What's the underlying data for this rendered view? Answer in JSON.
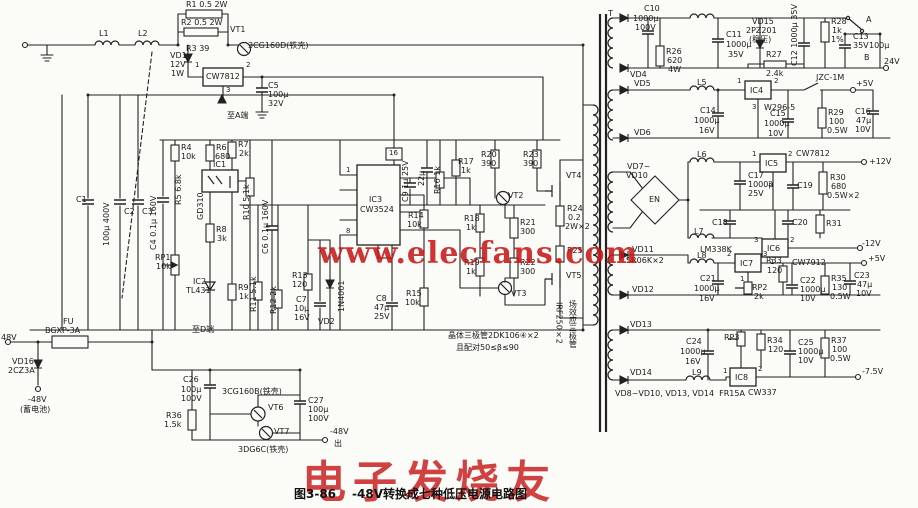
{
  "figure": {
    "number": "图3-86",
    "caption": "-48V转换成七种低压电源电路图"
  },
  "watermarks": {
    "center_url": "www.elecfans.com",
    "bottom_brand": "电子发烧友",
    "color": "#c61818"
  },
  "labels": [
    {
      "t": "L1",
      "x": 99,
      "y": 30
    },
    {
      "t": "L2",
      "x": 138,
      "y": 30
    },
    {
      "t": "R1 0.5 2W",
      "x": 186,
      "y": 1
    },
    {
      "t": "R2 0.5 2W",
      "x": 181,
      "y": 19
    },
    {
      "t": "R3 39",
      "x": 186,
      "y": 45
    },
    {
      "t": "VT1",
      "x": 230,
      "y": 26
    },
    {
      "t": "3CG160D(铁壳)",
      "x": 248,
      "y": 42
    },
    {
      "t": "VD1",
      "x": 170,
      "y": 52
    },
    {
      "t": "12V",
      "x": 170,
      "y": 61
    },
    {
      "t": "1W",
      "x": 171,
      "y": 70
    },
    {
      "t": "CW7812",
      "x": 206,
      "y": 73
    },
    {
      "t": "1",
      "x": 195,
      "y": 62,
      "c": "pin"
    },
    {
      "t": "2",
      "x": 246,
      "y": 62,
      "c": "pin"
    },
    {
      "t": "3",
      "x": 226,
      "y": 87,
      "c": "pin"
    },
    {
      "t": "C5",
      "x": 268,
      "y": 82
    },
    {
      "t": "100μ",
      "x": 268,
      "y": 91
    },
    {
      "t": "32V",
      "x": 268,
      "y": 100
    },
    {
      "t": "至A端",
      "x": 227,
      "y": 112
    },
    {
      "t": "C1",
      "x": 76,
      "y": 196
    },
    {
      "t": "100μ 400V",
      "x": 103,
      "y": 246,
      "c": "v"
    },
    {
      "t": "C2",
      "x": 124,
      "y": 208
    },
    {
      "t": "C3",
      "x": 142,
      "y": 208
    },
    {
      "t": "C4 0.1μ 160V",
      "x": 150,
      "y": 250,
      "c": "v"
    },
    {
      "t": "R4",
      "x": 181,
      "y": 144
    },
    {
      "t": "10k",
      "x": 181,
      "y": 153
    },
    {
      "t": "R5 6.8k",
      "x": 175,
      "y": 205,
      "c": "v"
    },
    {
      "t": "R6",
      "x": 216,
      "y": 144
    },
    {
      "t": "680",
      "x": 215,
      "y": 153
    },
    {
      "t": "R7",
      "x": 238,
      "y": 141
    },
    {
      "t": "2k",
      "x": 239,
      "y": 150
    },
    {
      "t": "IC1",
      "x": 213,
      "y": 161
    },
    {
      "t": "GD310",
      "x": 197,
      "y": 220,
      "c": "v"
    },
    {
      "t": "R8",
      "x": 216,
      "y": 226
    },
    {
      "t": "3k",
      "x": 217,
      "y": 235
    },
    {
      "t": "RP1",
      "x": 155,
      "y": 254
    },
    {
      "t": "10k",
      "x": 156,
      "y": 263
    },
    {
      "t": "IC2",
      "x": 193,
      "y": 278
    },
    {
      "t": "TL431",
      "x": 186,
      "y": 287
    },
    {
      "t": "R9",
      "x": 238,
      "y": 284
    },
    {
      "t": "1k",
      "x": 239,
      "y": 293
    },
    {
      "t": "R10 5.1k",
      "x": 243,
      "y": 220,
      "c": "v"
    },
    {
      "t": "C6 0.1μ 160V",
      "x": 262,
      "y": 254,
      "c": "v"
    },
    {
      "t": "R11 5.1k",
      "x": 250,
      "y": 312,
      "c": "v"
    },
    {
      "t": "R12 2k",
      "x": 270,
      "y": 314,
      "c": "v"
    },
    {
      "t": "R13",
      "x": 292,
      "y": 272
    },
    {
      "t": "120",
      "x": 292,
      "y": 281
    },
    {
      "t": "C7",
      "x": 296,
      "y": 296
    },
    {
      "t": "10μ",
      "x": 294,
      "y": 305
    },
    {
      "t": "16V",
      "x": 294,
      "y": 314
    },
    {
      "t": "VD2",
      "x": 318,
      "y": 318
    },
    {
      "t": "1N4001",
      "x": 338,
      "y": 312,
      "c": "v"
    },
    {
      "t": "IC3",
      "x": 369,
      "y": 196
    },
    {
      "t": "CW3524",
      "x": 360,
      "y": 206
    },
    {
      "t": "16",
      "x": 389,
      "y": 150,
      "c": "pin"
    },
    {
      "t": "1",
      "x": 346,
      "y": 167,
      "c": "pin"
    },
    {
      "t": "8",
      "x": 346,
      "y": 228,
      "c": "pin"
    },
    {
      "t": "C9 1μ 25V",
      "x": 402,
      "y": 202,
      "c": "v"
    },
    {
      "t": "22μ",
      "x": 418,
      "y": 186,
      "c": "v"
    },
    {
      "t": "R16 1k",
      "x": 434,
      "y": 194,
      "c": "v"
    },
    {
      "t": "R17",
      "x": 458,
      "y": 158
    },
    {
      "t": "1k",
      "x": 461,
      "y": 167
    },
    {
      "t": "R14",
      "x": 408,
      "y": 212
    },
    {
      "t": "10k",
      "x": 407,
      "y": 221
    },
    {
      "t": "R15",
      "x": 406,
      "y": 290
    },
    {
      "t": "10k",
      "x": 405,
      "y": 299
    },
    {
      "t": "C8",
      "x": 376,
      "y": 295
    },
    {
      "t": "47μ",
      "x": 374,
      "y": 304
    },
    {
      "t": "25V",
      "x": 374,
      "y": 313
    },
    {
      "t": "R20",
      "x": 481,
      "y": 151
    },
    {
      "t": "390",
      "x": 481,
      "y": 160
    },
    {
      "t": "R23",
      "x": 523,
      "y": 151
    },
    {
      "t": "390",
      "x": 523,
      "y": 160
    },
    {
      "t": "VT2",
      "x": 508,
      "y": 192
    },
    {
      "t": "VT3",
      "x": 511,
      "y": 290
    },
    {
      "t": "R18",
      "x": 464,
      "y": 215
    },
    {
      "t": "1k",
      "x": 466,
      "y": 224
    },
    {
      "t": "R19",
      "x": 464,
      "y": 259
    },
    {
      "t": "1k",
      "x": 466,
      "y": 268
    },
    {
      "t": "R21",
      "x": 520,
      "y": 219
    },
    {
      "t": "300",
      "x": 520,
      "y": 228
    },
    {
      "t": "R22",
      "x": 520,
      "y": 259
    },
    {
      "t": "300",
      "x": 520,
      "y": 268
    },
    {
      "t": "VT4",
      "x": 566,
      "y": 172
    },
    {
      "t": "VT5",
      "x": 566,
      "y": 272
    },
    {
      "t": "R24",
      "x": 567,
      "y": 205
    },
    {
      "t": "0.2",
      "x": 568,
      "y": 214
    },
    {
      "t": "2W×2",
      "x": 565,
      "y": 223
    },
    {
      "t": "R25",
      "x": 567,
      "y": 247
    },
    {
      "t": "场效应三极管",
      "x": 568,
      "y": 300,
      "c": "vc"
    },
    {
      "t": "IRF250×2",
      "x": 554,
      "y": 302,
      "c": "vc"
    },
    {
      "t": "晶体三极管2DK106④×2",
      "x": 448,
      "y": 332
    },
    {
      "t": "且配对50≤β≤90",
      "x": 456,
      "y": 344
    },
    {
      "t": "T",
      "x": 608,
      "y": 10
    },
    {
      "t": "C10",
      "x": 644,
      "y": 5
    },
    {
      "t": "1000μ",
      "x": 633,
      "y": 15
    },
    {
      "t": "100V",
      "x": 635,
      "y": 24
    },
    {
      "t": "R26",
      "x": 666,
      "y": 48
    },
    {
      "t": "620",
      "x": 667,
      "y": 57
    },
    {
      "t": "4W",
      "x": 668,
      "y": 66
    },
    {
      "t": "VD4",
      "x": 630,
      "y": 71
    },
    {
      "t": "C11",
      "x": 726,
      "y": 31
    },
    {
      "t": "1000μ",
      "x": 726,
      "y": 41
    },
    {
      "t": "35V",
      "x": 728,
      "y": 51
    },
    {
      "t": "VD15",
      "x": 752,
      "y": 18
    },
    {
      "t": "2PZ201",
      "x": 746,
      "y": 27
    },
    {
      "t": "(稳压)",
      "x": 749,
      "y": 36
    },
    {
      "t": "R27",
      "x": 766,
      "y": 51
    },
    {
      "t": "2.4k",
      "x": 766,
      "y": 70
    },
    {
      "t": "C12 1000μ 35V",
      "x": 791,
      "y": 66,
      "c": "v"
    },
    {
      "t": "R28",
      "x": 831,
      "y": 18
    },
    {
      "t": "1k",
      "x": 832,
      "y": 27
    },
    {
      "t": "1%",
      "x": 831,
      "y": 36
    },
    {
      "t": "A",
      "x": 866,
      "y": 16
    },
    {
      "t": "C13",
      "x": 853,
      "y": 33
    },
    {
      "t": "35V",
      "x": 853,
      "y": 42
    },
    {
      "t": "100μ",
      "x": 869,
      "y": 42
    },
    {
      "t": "B",
      "x": 864,
      "y": 54
    },
    {
      "t": "24V",
      "x": 884,
      "y": 58
    },
    {
      "t": "JZC-1M",
      "x": 816,
      "y": 74
    },
    {
      "t": "+5V",
      "x": 856,
      "y": 80
    },
    {
      "t": "VD5",
      "x": 634,
      "y": 80
    },
    {
      "t": "VD6",
      "x": 634,
      "y": 129
    },
    {
      "t": "L5",
      "x": 697,
      "y": 79
    },
    {
      "t": "IC4",
      "x": 750,
      "y": 87
    },
    {
      "t": "1",
      "x": 737,
      "y": 78,
      "c": "pin"
    },
    {
      "t": "2",
      "x": 774,
      "y": 78,
      "c": "pin"
    },
    {
      "t": "3",
      "x": 752,
      "y": 104,
      "c": "pin"
    },
    {
      "t": "W296-5",
      "x": 764,
      "y": 104
    },
    {
      "t": "C14",
      "x": 700,
      "y": 107
    },
    {
      "t": "1000μ",
      "x": 694,
      "y": 117
    },
    {
      "t": "16V",
      "x": 699,
      "y": 127
    },
    {
      "t": "C15",
      "x": 770,
      "y": 110
    },
    {
      "t": "1000μ",
      "x": 764,
      "y": 120
    },
    {
      "t": "10V",
      "x": 768,
      "y": 130
    },
    {
      "t": "R29",
      "x": 828,
      "y": 109
    },
    {
      "t": "100",
      "x": 829,
      "y": 118
    },
    {
      "t": "0.5W",
      "x": 827,
      "y": 127
    },
    {
      "t": "C16",
      "x": 855,
      "y": 108
    },
    {
      "t": "47μ",
      "x": 856,
      "y": 117
    },
    {
      "t": "10V",
      "x": 855,
      "y": 126
    },
    {
      "t": "VD7~",
      "x": 627,
      "y": 163
    },
    {
      "t": "VD10",
      "x": 626,
      "y": 172
    },
    {
      "t": "EN",
      "x": 649,
      "y": 196
    },
    {
      "t": "L6",
      "x": 697,
      "y": 151
    },
    {
      "t": "IC5",
      "x": 765,
      "y": 160
    },
    {
      "t": "1",
      "x": 752,
      "y": 151,
      "c": "pin"
    },
    {
      "t": "2",
      "x": 788,
      "y": 151,
      "c": "pin"
    },
    {
      "t": "3",
      "x": 768,
      "y": 181,
      "c": "pin"
    },
    {
      "t": "CW7812",
      "x": 796,
      "y": 150
    },
    {
      "t": "+12V",
      "x": 869,
      "y": 158
    },
    {
      "t": "C17",
      "x": 748,
      "y": 172
    },
    {
      "t": "1000μ",
      "x": 748,
      "y": 181
    },
    {
      "t": "25V",
      "x": 748,
      "y": 190
    },
    {
      "t": "C18",
      "x": 712,
      "y": 219
    },
    {
      "t": "C19",
      "x": 797,
      "y": 182
    },
    {
      "t": "C20",
      "x": 792,
      "y": 219
    },
    {
      "t": "R30",
      "x": 830,
      "y": 174
    },
    {
      "t": "680",
      "x": 831,
      "y": 183
    },
    {
      "t": "0.5W×2",
      "x": 827,
      "y": 192
    },
    {
      "t": "R31",
      "x": 826,
      "y": 220
    },
    {
      "t": "L7",
      "x": 694,
      "y": 228
    },
    {
      "t": "LM338K",
      "x": 700,
      "y": 246
    },
    {
      "t": "IC6",
      "x": 767,
      "y": 245
    },
    {
      "t": "3",
      "x": 754,
      "y": 237,
      "c": "pin"
    },
    {
      "t": "2",
      "x": 790,
      "y": 237,
      "c": "pin"
    },
    {
      "t": "1",
      "x": 770,
      "y": 259,
      "c": "pin"
    },
    {
      "t": "CW7912",
      "x": 792,
      "y": 259
    },
    {
      "t": "-12V",
      "x": 862,
      "y": 240
    },
    {
      "t": "VD11",
      "x": 632,
      "y": 246
    },
    {
      "t": "SR06K×2",
      "x": 626,
      "y": 257
    },
    {
      "t": "VD12",
      "x": 632,
      "y": 286
    },
    {
      "t": "L8",
      "x": 697,
      "y": 252
    },
    {
      "t": "IC7",
      "x": 740,
      "y": 260
    },
    {
      "t": "2",
      "x": 727,
      "y": 251,
      "c": "pin"
    },
    {
      "t": "3",
      "x": 763,
      "y": 251,
      "c": "pin"
    },
    {
      "t": "1",
      "x": 740,
      "y": 276,
      "c": "pin"
    },
    {
      "t": "C21",
      "x": 700,
      "y": 275
    },
    {
      "t": "1000μ",
      "x": 694,
      "y": 285
    },
    {
      "t": "16V",
      "x": 699,
      "y": 295
    },
    {
      "t": "RP2",
      "x": 752,
      "y": 284
    },
    {
      "t": "2k",
      "x": 754,
      "y": 293
    },
    {
      "t": "R33",
      "x": 766,
      "y": 257
    },
    {
      "t": "120",
      "x": 767,
      "y": 267
    },
    {
      "t": "C22",
      "x": 800,
      "y": 277
    },
    {
      "t": "1000μ",
      "x": 800,
      "y": 286
    },
    {
      "t": "10V",
      "x": 800,
      "y": 295
    },
    {
      "t": "R35",
      "x": 831,
      "y": 275
    },
    {
      "t": "130",
      "x": 832,
      "y": 284
    },
    {
      "t": "0.5W",
      "x": 830,
      "y": 293
    },
    {
      "t": "C23",
      "x": 854,
      "y": 272
    },
    {
      "t": "47μ",
      "x": 857,
      "y": 281
    },
    {
      "t": "10V",
      "x": 856,
      "y": 290
    },
    {
      "t": "+5V",
      "x": 868,
      "y": 255
    },
    {
      "t": "VD13",
      "x": 630,
      "y": 321
    },
    {
      "t": "VD14",
      "x": 630,
      "y": 369
    },
    {
      "t": "L9",
      "x": 692,
      "y": 369
    },
    {
      "t": "C24",
      "x": 686,
      "y": 338
    },
    {
      "t": "1000μ",
      "x": 680,
      "y": 348
    },
    {
      "t": "16V",
      "x": 685,
      "y": 358
    },
    {
      "t": "RP3",
      "x": 724,
      "y": 334
    },
    {
      "t": "R34",
      "x": 767,
      "y": 337
    },
    {
      "t": "120",
      "x": 768,
      "y": 346
    },
    {
      "t": "IC8",
      "x": 735,
      "y": 374
    },
    {
      "t": "1",
      "x": 723,
      "y": 368,
      "c": "pin"
    },
    {
      "t": "2",
      "x": 758,
      "y": 366,
      "c": "pin"
    },
    {
      "t": "CW337",
      "x": 748,
      "y": 389
    },
    {
      "t": "C25",
      "x": 798,
      "y": 339
    },
    {
      "t": "1000μ",
      "x": 798,
      "y": 348
    },
    {
      "t": "10V",
      "x": 798,
      "y": 357
    },
    {
      "t": "R37",
      "x": 831,
      "y": 337
    },
    {
      "t": "100",
      "x": 832,
      "y": 346
    },
    {
      "t": "0.5W",
      "x": 830,
      "y": 355
    },
    {
      "t": "-7.5V",
      "x": 862,
      "y": 368
    },
    {
      "t": "VD8~VD10, VD13, VD14  FR15A",
      "x": 615,
      "y": 390
    },
    {
      "t": "48V",
      "x": 1,
      "y": 334
    },
    {
      "t": "FU",
      "x": 63,
      "y": 318
    },
    {
      "t": "BGXP-3A",
      "x": 45,
      "y": 327
    },
    {
      "t": "VD16",
      "x": 12,
      "y": 358
    },
    {
      "t": "2CZ3A",
      "x": 8,
      "y": 367
    },
    {
      "t": "-48V",
      "x": 28,
      "y": 396
    },
    {
      "t": "(蓄电池)",
      "x": 20,
      "y": 406
    },
    {
      "t": "至D端",
      "x": 192,
      "y": 326
    },
    {
      "t": "C26",
      "x": 183,
      "y": 376
    },
    {
      "t": "100μ",
      "x": 181,
      "y": 386
    },
    {
      "t": "100V",
      "x": 181,
      "y": 395
    },
    {
      "t": "3CG160B(铁壳)",
      "x": 222,
      "y": 388
    },
    {
      "t": "R36",
      "x": 166,
      "y": 412
    },
    {
      "t": "1.5k",
      "x": 164,
      "y": 421
    },
    {
      "t": "VT6",
      "x": 268,
      "y": 404
    },
    {
      "t": "VT7",
      "x": 274,
      "y": 428
    },
    {
      "t": "3DG6C(铁壳)",
      "x": 238,
      "y": 446
    },
    {
      "t": "C27",
      "x": 308,
      "y": 397
    },
    {
      "t": "100μ",
      "x": 308,
      "y": 406
    },
    {
      "t": "100V",
      "x": 308,
      "y": 415
    },
    {
      "t": "-48V",
      "x": 330,
      "y": 428
    },
    {
      "t": "出",
      "x": 334,
      "y": 440
    }
  ]
}
